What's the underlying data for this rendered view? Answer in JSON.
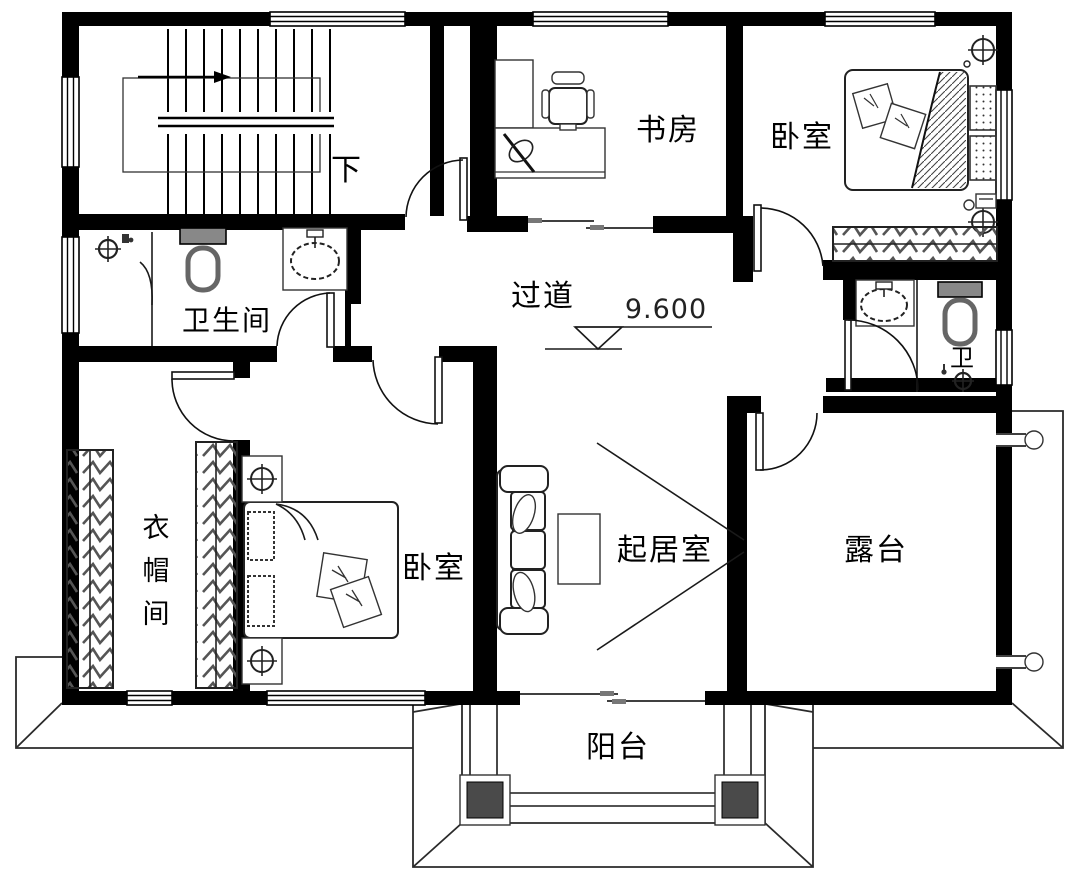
{
  "rooms": {
    "stairwell": {
      "label": "下"
    },
    "bathroom_main": {
      "label": "卫生间"
    },
    "study": {
      "label": "书房"
    },
    "bedroom_top": {
      "label": "卧室"
    },
    "hallway": {
      "label": "过道"
    },
    "bathroom_small": {
      "label": "卫"
    },
    "closet": {
      "chars": [
        "衣",
        "帽",
        "间"
      ]
    },
    "bedroom_main": {
      "label": "卧室"
    },
    "living_room": {
      "label": "起居室"
    },
    "terrace": {
      "label": "露台"
    },
    "balcony": {
      "label": "阳台"
    }
  },
  "annotations": {
    "floor_elevation": "9.600"
  },
  "colors": {
    "wall": "#000000",
    "background": "#ffffff",
    "furniture_line": "#222222",
    "fixture_gray": "#6e6e6e",
    "column_fill": "#4a4a4a"
  }
}
